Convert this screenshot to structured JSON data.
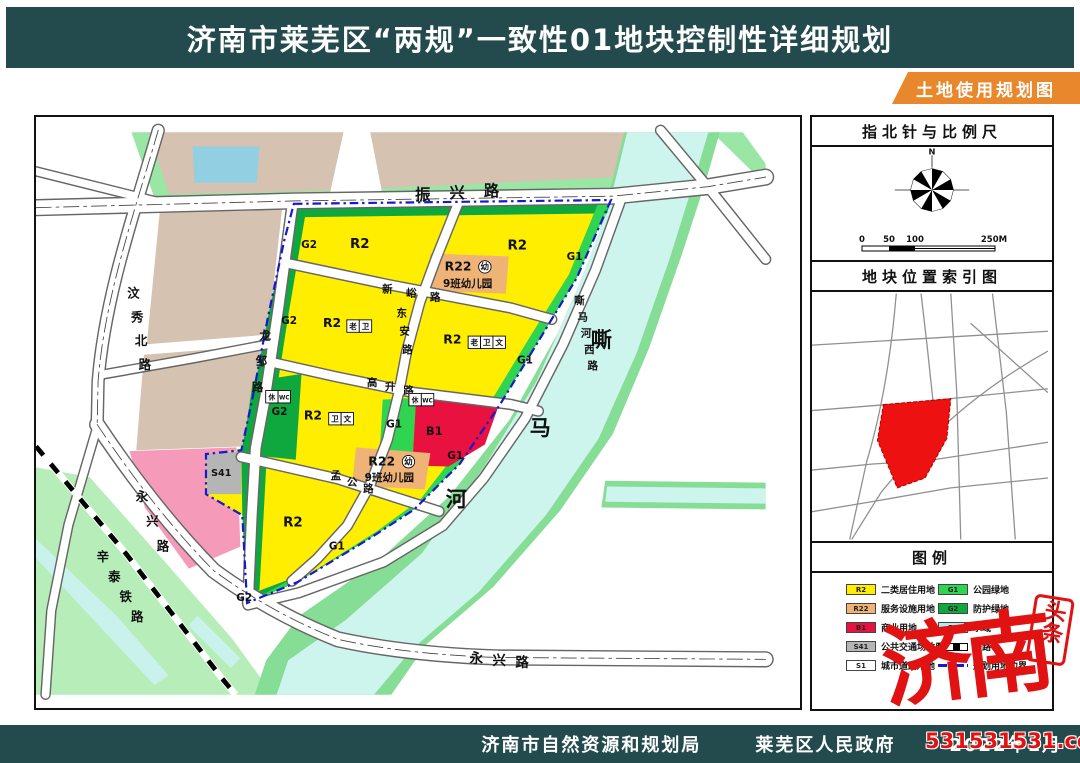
{
  "header": {
    "title": "济南市莱芜区“两规”一致性01地块控制性详细规划",
    "ribbon": "土地使用规划图"
  },
  "footer": {
    "agency_left": "济南市自然资源和规划局",
    "agency_right": "莱芜区人民政府",
    "date": "2022年1月"
  },
  "watermark": {
    "big_text": "济南",
    "seal_text": "头条",
    "url_text": "531531531.com"
  },
  "sidebar": {
    "section1_title": "指北针与比例尺",
    "compass_north_label": "N",
    "scale_labels": [
      "0",
      "50",
      "100",
      "250M"
    ],
    "section2_title": "地块位置索引图",
    "section3_title": "图例",
    "legend": {
      "left": [
        {
          "code": "R2",
          "label": "二类居住用地",
          "color": "#ffee00"
        },
        {
          "code": "R22",
          "label": "服务设施用地",
          "color": "#efb377"
        },
        {
          "code": "B1",
          "label": "商业用地",
          "color": "#e8113f"
        },
        {
          "code": "S41",
          "label": "公共交通场站用地",
          "color": "#b5b5b5"
        },
        {
          "code": "S1",
          "label": "城市道路用地",
          "color": "#ffffff"
        }
      ],
      "right": [
        {
          "code": "G1",
          "label": "公园绿地",
          "color": "#2fd551"
        },
        {
          "code": "G2",
          "label": "防护绿地",
          "color": "#0fa83e"
        },
        {
          "code": "E1",
          "label": "水域",
          "color": "#aeeef0"
        },
        {
          "code": "",
          "label": "铁路",
          "symbol": "railway"
        },
        {
          "code": "",
          "label": "规划用地边界",
          "symbol": "boundary"
        }
      ]
    }
  },
  "map": {
    "colors": {
      "residential_R2": "#ffee00",
      "service_R22": "#efb377",
      "commercial_B1": "#e8113f",
      "transit_S41": "#b5b5b5",
      "park_G1": "#2fd551",
      "protect_G2": "#0fa83e",
      "water_E1": "#cdf4ed",
      "bank_green": "#86dd96",
      "existing_tan": "#d5c2b0",
      "pink_block": "#f59ab9",
      "boundary_blue": "#1818d0"
    },
    "labels": [
      {
        "t": "振兴路",
        "x": 441,
        "y": 190,
        "dx": 36,
        "dy": -2,
        "s": 16,
        "b": 1
      },
      {
        "t": "汶秀北路",
        "x": 138,
        "y": 292,
        "dx": 4,
        "dy": 25,
        "s": 13,
        "b": 1
      },
      {
        "t": "龙邹路",
        "x": 276,
        "y": 336,
        "dx": -4,
        "dy": 27,
        "s": 12,
        "b": 1
      },
      {
        "t": "新峪路",
        "x": 404,
        "y": 287,
        "dx": 25,
        "dy": 4,
        "s": 11,
        "b": 1
      },
      {
        "t": "东安路",
        "x": 419,
        "y": 312,
        "dx": 3,
        "dy": 19,
        "s": 11,
        "b": 1
      },
      {
        "t": "高升路",
        "x": 388,
        "y": 385,
        "dx": 19,
        "dy": 4,
        "s": 11,
        "b": 1
      },
      {
        "t": "孟公路",
        "x": 350,
        "y": 482,
        "dx": 17,
        "dy": 7,
        "s": 11,
        "b": 1
      },
      {
        "t": "嘶马河西路",
        "x": 605,
        "y": 299,
        "dx": 3.5,
        "dy": 17,
        "s": 11,
        "b": 1
      },
      {
        "t": "永兴路",
        "x": 147,
        "y": 505,
        "dx": 11,
        "dy": 26,
        "s": 13,
        "b": 1
      },
      {
        "t": "永兴路",
        "x": 497,
        "y": 675,
        "dx": 24,
        "dy": 2,
        "s": 14,
        "b": 1
      },
      {
        "t": "辛泰铁路",
        "x": 106,
        "y": 568,
        "dx": 12,
        "dy": 21,
        "s": 13,
        "b": 1
      },
      {
        "t": "嘶",
        "x": 628,
        "y": 344,
        "s": 22,
        "b": 1
      },
      {
        "t": "马",
        "x": 564,
        "y": 436,
        "s": 22,
        "b": 1
      },
      {
        "t": "河",
        "x": 476,
        "y": 511,
        "s": 22,
        "b": 1
      },
      {
        "t": "G2",
        "x": 322,
        "y": 240,
        "s": 11,
        "b": 1
      },
      {
        "t": "G2",
        "x": 301,
        "y": 320,
        "s": 11,
        "b": 1
      },
      {
        "t": "G2",
        "x": 291,
        "y": 415,
        "s": 11,
        "b": 1
      },
      {
        "t": "G2",
        "x": 254,
        "y": 610,
        "s": 11,
        "b": 1
      },
      {
        "t": "R2",
        "x": 375,
        "y": 240,
        "s": 14,
        "b": 1
      },
      {
        "t": "R2",
        "x": 540,
        "y": 242,
        "s": 14,
        "b": 1
      },
      {
        "t": "R2",
        "x": 305,
        "y": 532,
        "s": 14,
        "b": 1
      },
      {
        "t": "R2",
        "x": 346,
        "y": 323,
        "s": 13,
        "b": 1
      },
      {
        "t": "老",
        "x": 368,
        "y": 322,
        "s": 8,
        "box": 1
      },
      {
        "t": "卫",
        "x": 381,
        "y": 322,
        "s": 8,
        "box": 1
      },
      {
        "t": "R2",
        "x": 472,
        "y": 340,
        "s": 13,
        "b": 1
      },
      {
        "t": "老",
        "x": 495,
        "y": 339,
        "s": 8,
        "box": 1
      },
      {
        "t": "卫",
        "x": 508,
        "y": 339,
        "s": 8,
        "box": 1
      },
      {
        "t": "文",
        "x": 521,
        "y": 339,
        "s": 8,
        "box": 1
      },
      {
        "t": "R2",
        "x": 326,
        "y": 420,
        "s": 13,
        "b": 1
      },
      {
        "t": "卫",
        "x": 349,
        "y": 419,
        "s": 8,
        "box": 1
      },
      {
        "t": "文",
        "x": 362,
        "y": 419,
        "s": 8,
        "box": 1
      },
      {
        "t": "G1",
        "x": 600,
        "y": 253,
        "s": 11,
        "b": 1
      },
      {
        "t": "G1",
        "x": 548,
        "y": 361,
        "s": 11,
        "b": 1
      },
      {
        "t": "G1",
        "x": 411,
        "y": 428,
        "s": 11,
        "b": 1
      },
      {
        "t": "G1",
        "x": 475,
        "y": 461,
        "s": 11,
        "b": 1
      },
      {
        "t": "G1",
        "x": 351,
        "y": 556,
        "s": 11,
        "b": 1
      },
      {
        "t": "B1",
        "x": 453,
        "y": 436,
        "s": 12,
        "b": 1
      },
      {
        "t": "S41",
        "x": 230,
        "y": 479,
        "s": 10,
        "b": 1
      },
      {
        "t": "R22",
        "x": 478,
        "y": 264,
        "s": 13,
        "b": 1
      },
      {
        "t": "幼",
        "x": 506,
        "y": 260,
        "s": 9,
        "box": 2
      },
      {
        "t": "9班幼儿园",
        "x": 488,
        "y": 281,
        "s": 11,
        "b": 1
      },
      {
        "t": "R22",
        "x": 398,
        "y": 468,
        "s": 13,
        "b": 1
      },
      {
        "t": "幼",
        "x": 426,
        "y": 464,
        "s": 9,
        "box": 2
      },
      {
        "t": "9班幼儿园",
        "x": 406,
        "y": 484,
        "s": 11,
        "b": 1
      },
      {
        "t": "休",
        "x": 283,
        "y": 396,
        "s": 7,
        "box": 1
      },
      {
        "t": "WC",
        "x": 296,
        "y": 396,
        "s": 6,
        "box": 1
      },
      {
        "t": "休",
        "x": 433,
        "y": 399,
        "s": 7,
        "box": 1
      },
      {
        "t": "WC",
        "x": 446,
        "y": 399,
        "s": 6,
        "box": 1
      }
    ]
  }
}
